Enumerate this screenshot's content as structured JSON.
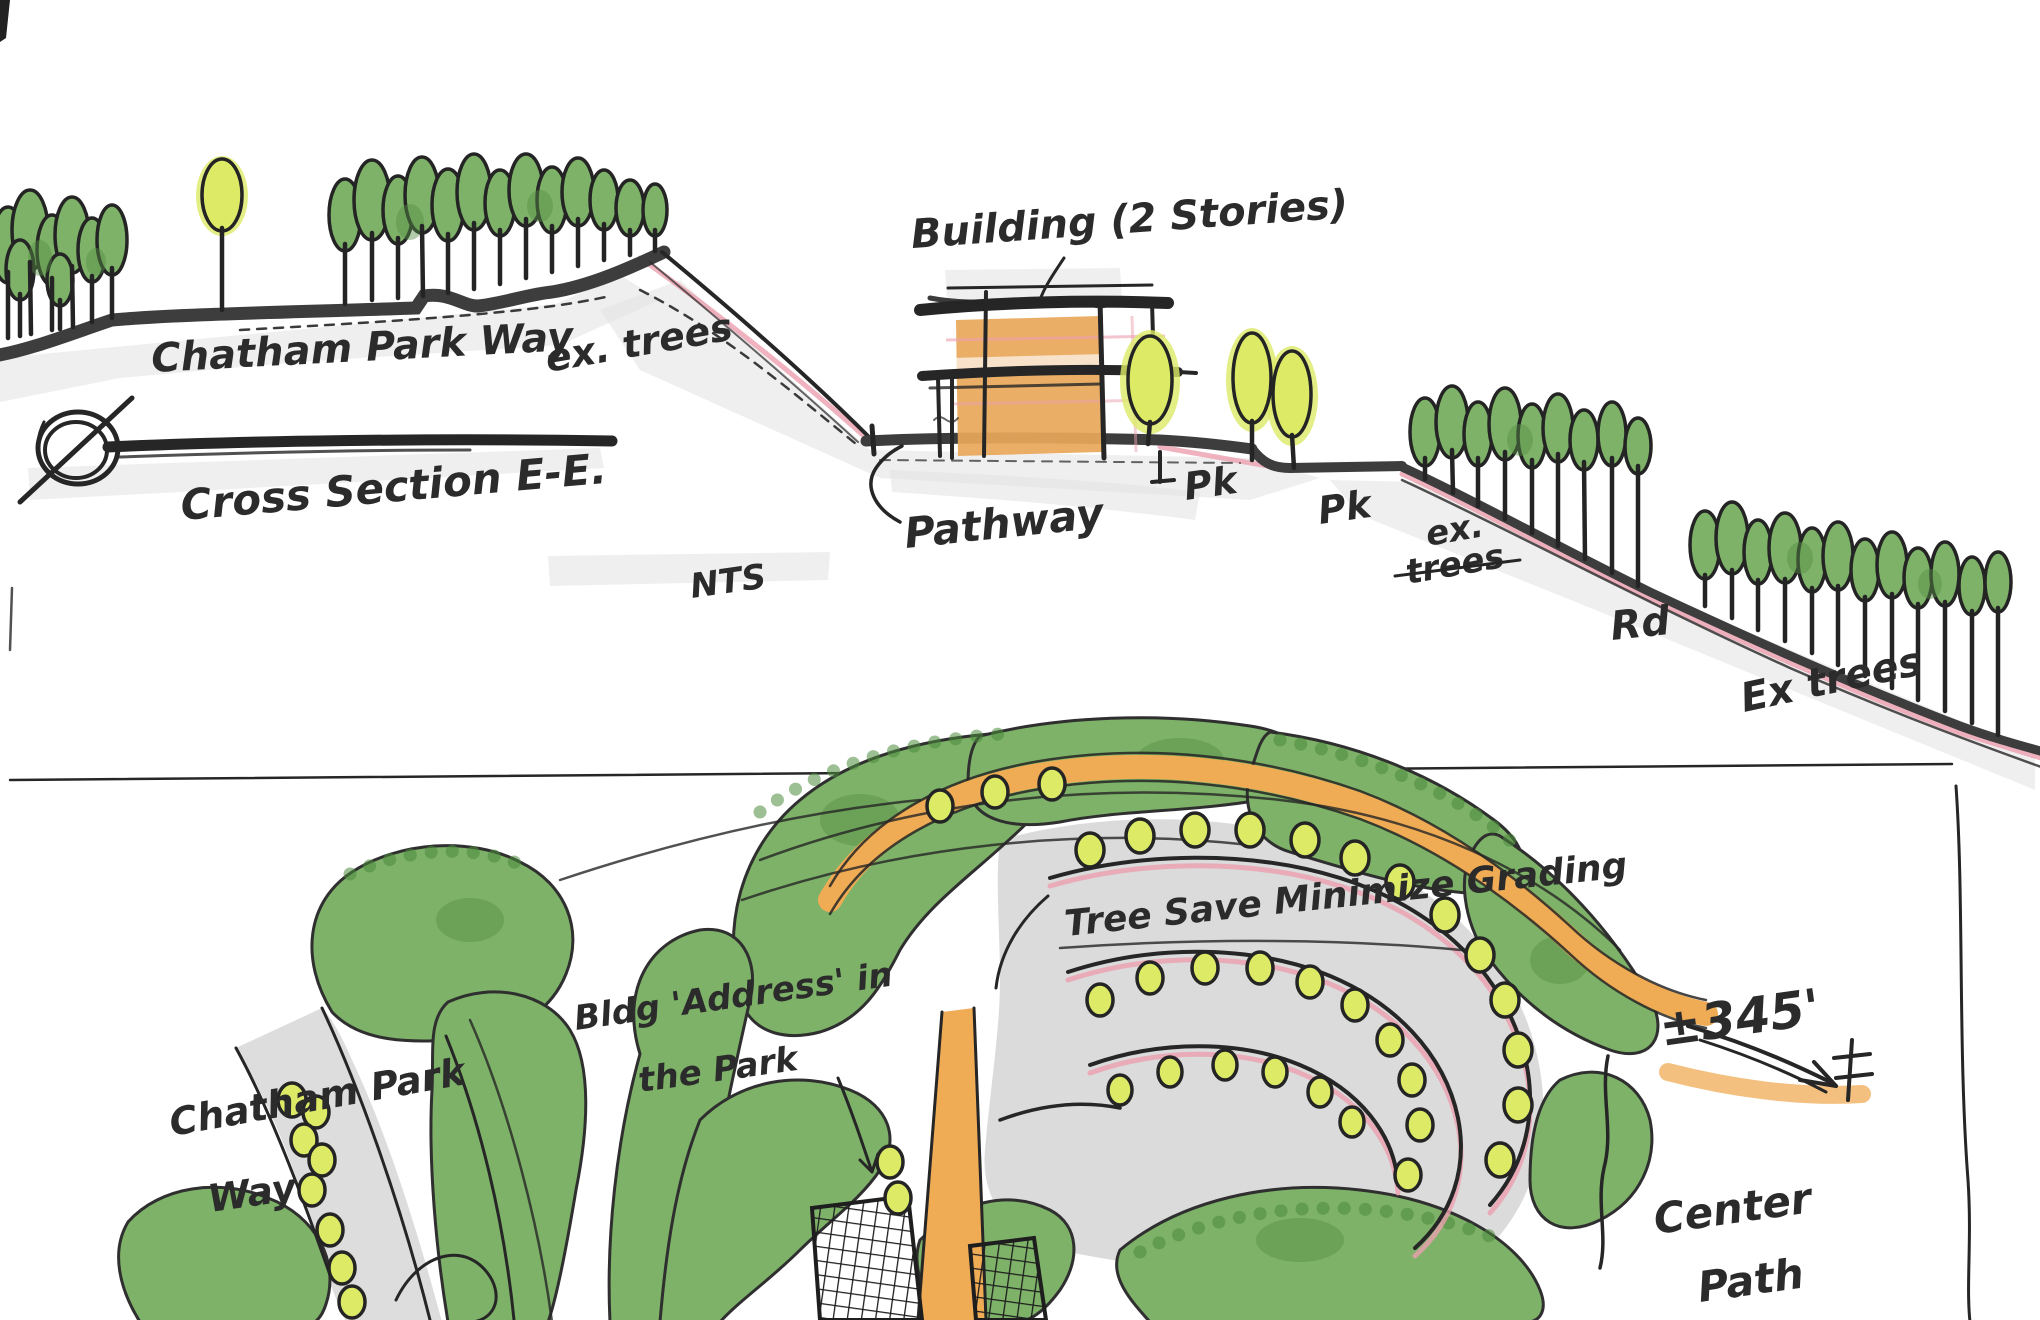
{
  "colors": {
    "paper": "#ffffff",
    "ink": "#262626",
    "road_band": "#3d3d3d",
    "tree_green": "#7db268",
    "tree_green_dark": "#578f45",
    "accent_yellow_green": "#dcea66",
    "building_orange": "#e9a75a",
    "path_orange": "#f0ab55",
    "road_gray": "#d9d9d9",
    "wash_gray": "#e2e2e2",
    "pink_edge": "#eb9fae"
  },
  "section_view": {
    "title": "Cross Section E-E.",
    "scale_note": "NTS",
    "labels": {
      "road_left": "Chatham Park Way",
      "existing_trees_left": "ex. trees",
      "building": "Building (2 Stories)",
      "pathway": "Pathway",
      "park_1": "Pk",
      "park_2": "Pk",
      "existing_trees_mid_line1": "ex.",
      "existing_trees_mid_line2": "trees",
      "road_right": "Rd",
      "existing_trees_right": "Ex trees"
    }
  },
  "plan_view": {
    "labels": {
      "tree_save": "Tree Save Minimize Grading",
      "building_address_line1": "Bldg 'Address' in",
      "building_address_line2": "the Park",
      "road_left_line1": "Chatham Park",
      "road_left_line2": "Way",
      "spot_elevation": "±345'",
      "center_path_line1": "Center",
      "center_path_line2": "Path"
    }
  }
}
